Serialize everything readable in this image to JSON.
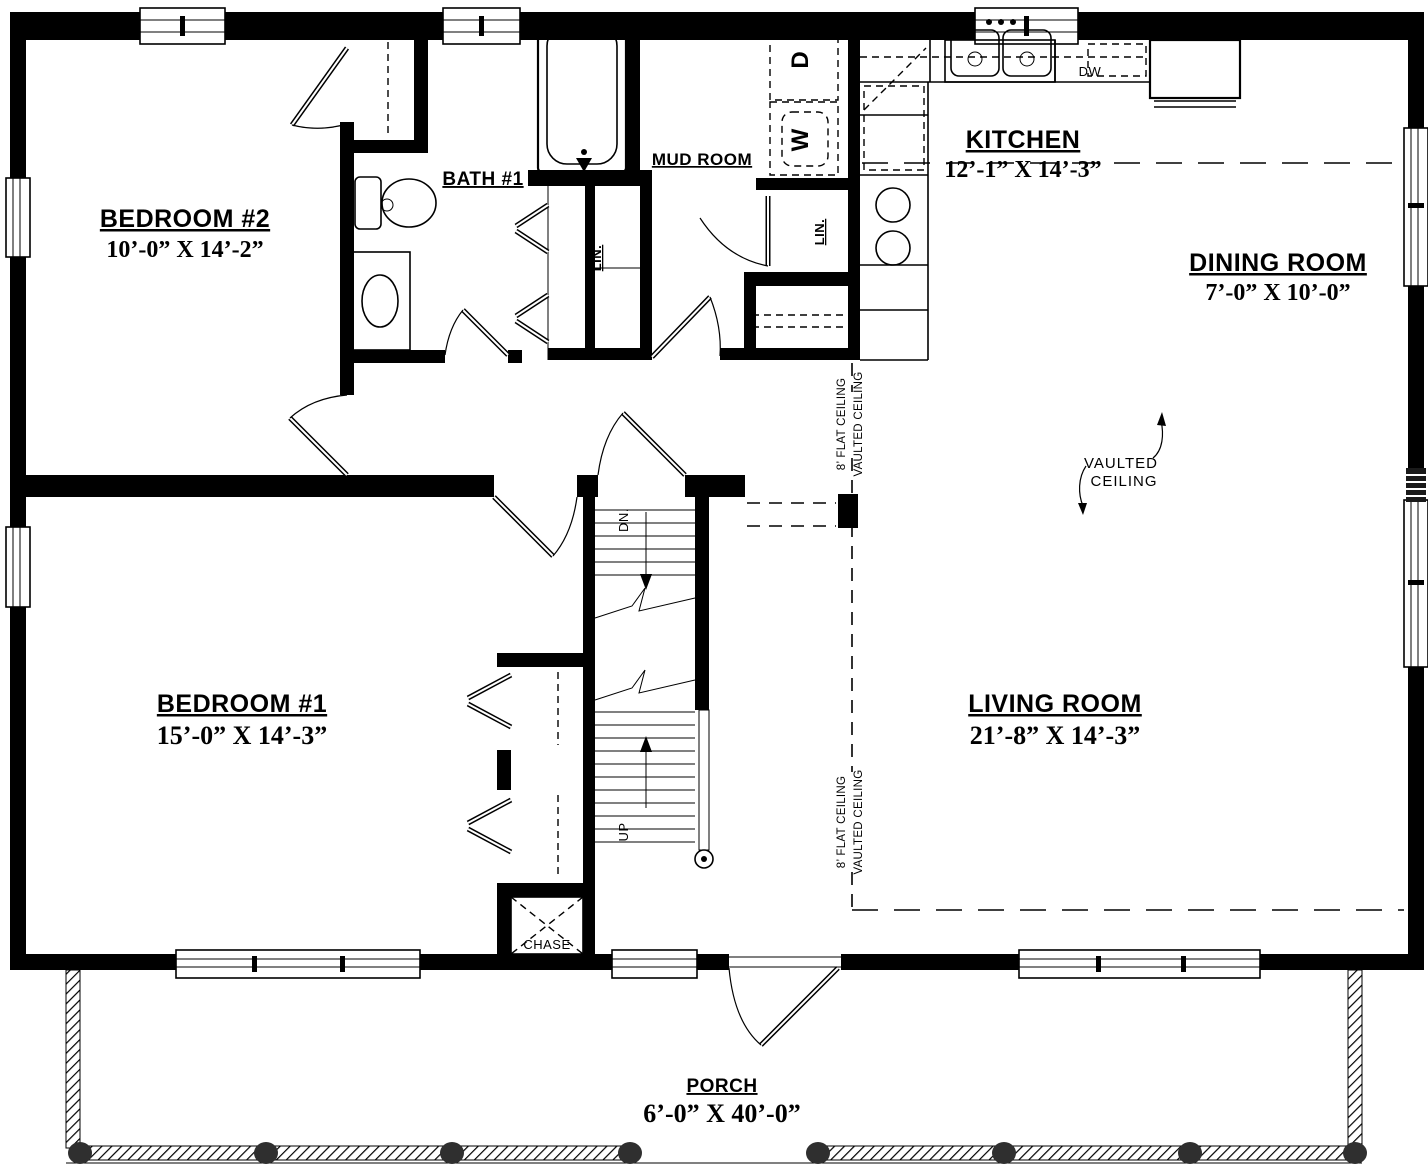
{
  "rooms": {
    "bedroom2": {
      "name": "BEDROOM #2",
      "dims": "10’-0”  X  14’-2”"
    },
    "bath1": {
      "name": "BATH #1"
    },
    "mudroom": {
      "name": "MUD ROOM"
    },
    "kitchen": {
      "name": "KITCHEN",
      "dims": "12’-1”  X  14’-3”"
    },
    "dining": {
      "name": "DINING ROOM",
      "dims": "7’-0”  X  10’-0”"
    },
    "bedroom1": {
      "name": "BEDROOM #1",
      "dims": "15’-0”  X  14’-3”"
    },
    "living": {
      "name": "LIVING ROOM",
      "dims": "21’-8”  X  14’-3”"
    },
    "porch": {
      "name": "PORCH",
      "dims": "6’-0”  X  40’-0”"
    }
  },
  "labels": {
    "linen_hall": "LIN.",
    "linen_mud": "LIN.",
    "chase": "CHASE",
    "stairs_down": "DN.",
    "stairs_up": "UP",
    "dryer": "D",
    "washer": "W",
    "dishwasher": "DW"
  },
  "ceiling": {
    "flat": "8’ FLAT CEILING",
    "vaulted": "VAULTED CEILING",
    "note_line1": "VAULTED",
    "note_line2": "CEILING"
  },
  "colors": {
    "ink": "#000000",
    "paper": "#ffffff",
    "post": "#2f2f2f"
  }
}
